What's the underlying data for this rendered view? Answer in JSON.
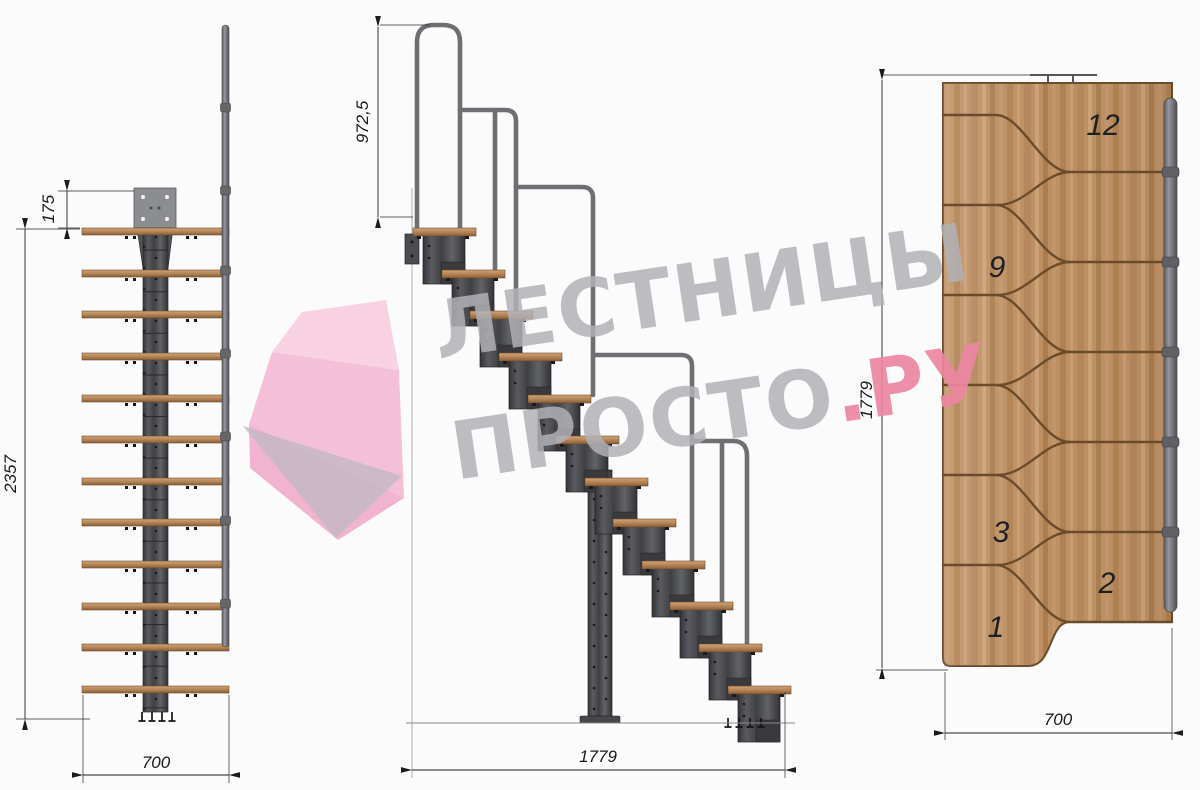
{
  "watermark": {
    "line1": "ЛЕСТНИЦЫ",
    "line2": "ПРОСТО",
    "line2_suffix": ".РУ"
  },
  "front_view": {
    "dim_plate_offset": "175",
    "dim_height": "2357",
    "dim_width": "700"
  },
  "side_view": {
    "dim_rail_height": "972,5",
    "dim_length": "1779"
  },
  "plan_view": {
    "dim_length": "1779",
    "dim_width": "700",
    "step_numbers": [
      "12",
      "9",
      "3",
      "2",
      "1"
    ]
  },
  "colors": {
    "wood": "#bb8d60",
    "metal_dark": "#47484c",
    "metal_light": "#7c7d82",
    "dimension_lines": "#1c1c1e",
    "watermark_gray": "#b2b2b8",
    "watermark_pink": "#ec87a2"
  }
}
